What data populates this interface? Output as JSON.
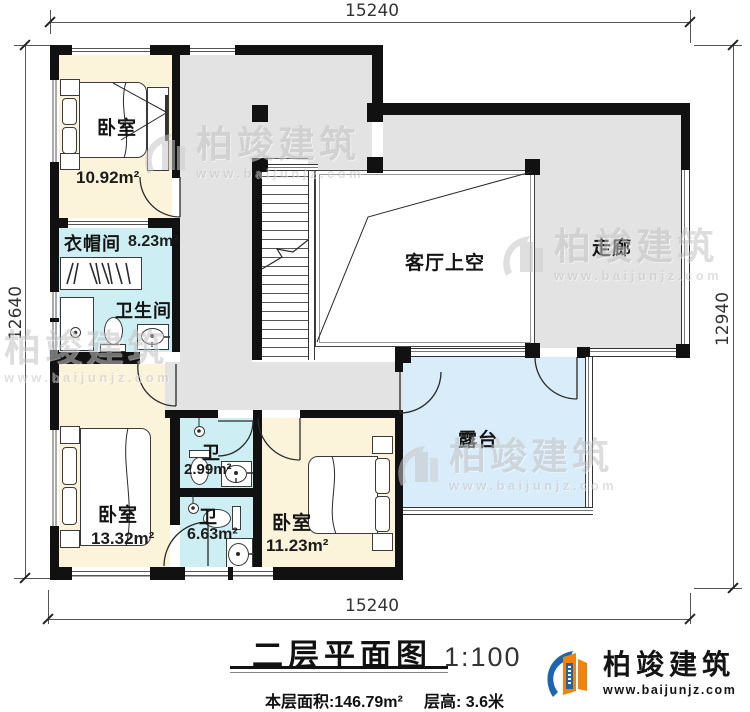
{
  "dimensions": {
    "top": "15240",
    "bottom": "15240",
    "left": "12640",
    "right": "12940"
  },
  "rooms": {
    "bedroom1": {
      "label": "卧室",
      "area": "10.92m²"
    },
    "cloakroom": {
      "label": "衣帽间",
      "area": "8.23m²"
    },
    "bathroom": {
      "label": "卫生间"
    },
    "living_void": {
      "label": "客厅上空"
    },
    "corridor": {
      "label": "走廊"
    },
    "bedroom2": {
      "label": "卧室",
      "area": "13.32m²"
    },
    "wc1": {
      "label": "卫",
      "area": "2.99m²"
    },
    "wc2": {
      "label": "卫",
      "area": "6.63m²"
    },
    "bedroom3": {
      "label": "卧室",
      "area": "11.23m²"
    },
    "terrace": {
      "label": "露台"
    }
  },
  "titleblock": {
    "title": "二层平面图",
    "scale": "1:100",
    "floor_area": "本层面积:146.79m²",
    "floor_height": "层高: 3.6米"
  },
  "brand": {
    "name": "柏竣建筑",
    "website": "www.baijunjz.com"
  },
  "watermark": {
    "name": "柏竣建筑",
    "website": "www.baijunjz.com"
  },
  "colors": {
    "wall": "#111111",
    "cream": "#fbf3da",
    "cyan": "#cdeff3",
    "gray": "#e3e3e4",
    "terrace": "#d9ecfa",
    "brand_blue": "#1b66ae",
    "brand_orange": "#f0830f"
  }
}
